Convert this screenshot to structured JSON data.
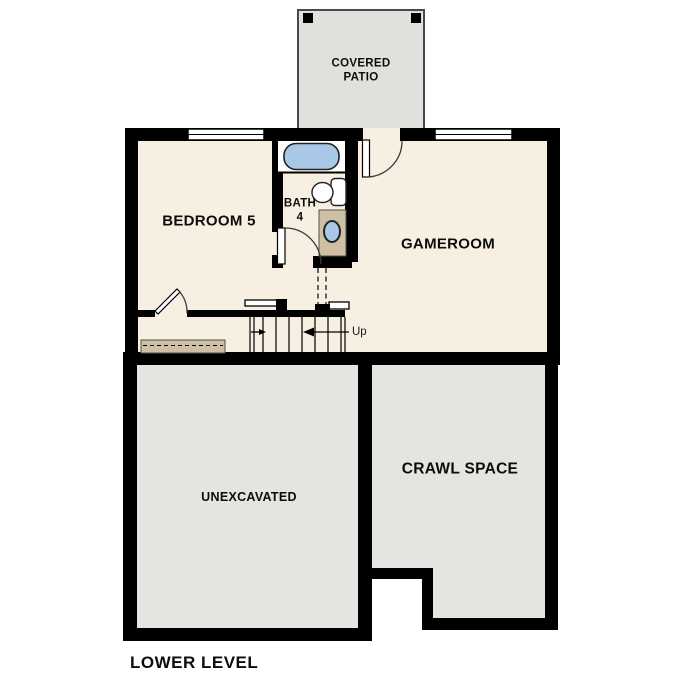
{
  "plan": {
    "title": "LOWER LEVEL",
    "rooms": {
      "covered_patio_line1": "COVERED",
      "covered_patio_line2": "PATIO",
      "bedroom": "BEDROOM 5",
      "bath_line1": "BATH",
      "bath_line2": "4",
      "gameroom": "GAMEROOM",
      "unexcavated": "UNEXCAVATED",
      "crawl_space": "CRAWL SPACE",
      "stair_direction": "Up"
    },
    "colors": {
      "wall": "#000000",
      "floor": "#f7efe2",
      "area-gray": "#e6e4e1",
      "patio-gray": "#e2e0dc",
      "fixture-blue": "#a9c8e7",
      "wood-tan": "#cec0a5",
      "arc-line": "#3a3a3a"
    }
  }
}
